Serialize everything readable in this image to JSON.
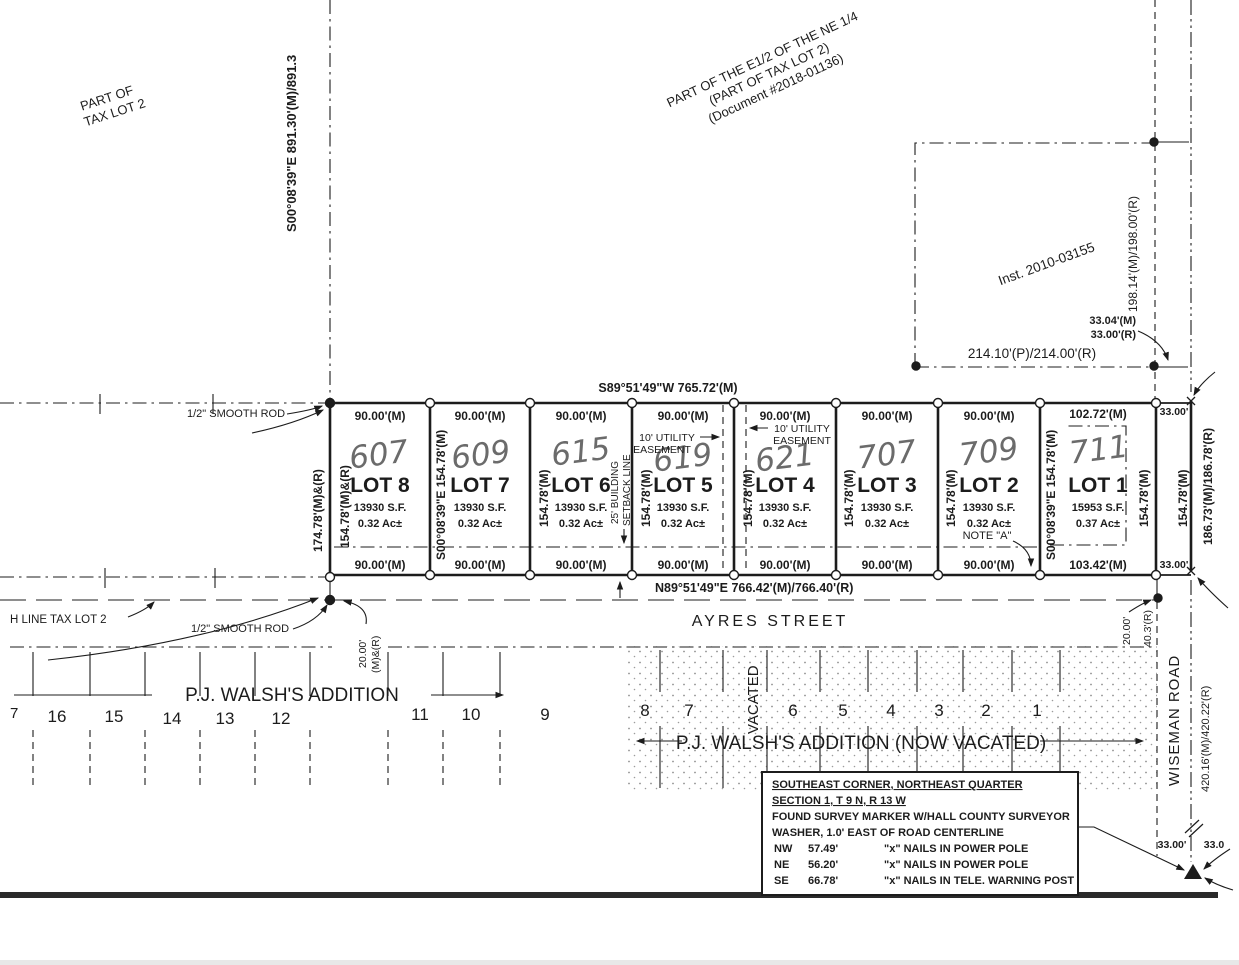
{
  "notes": {
    "tax_lot_1": "PART OF",
    "tax_lot_2": "TAX LOT 2",
    "ne_1": "PART OF THE E1/2 OF THE NE 1/4",
    "ne_2": "(PART OF TAX LOT 2)",
    "ne_3": "(Document #2018-01136)",
    "inst": "Inst. 2010-03155",
    "rod_top": "1/2\" SMOOTH ROD",
    "rod_bottom": "1/2\" SMOOTH ROD",
    "h_line": "H LINE TAX LOT 2",
    "note_a": "NOTE \"A\"",
    "utility_left_1": "10' UTILITY",
    "utility_left_2": "EASEMENT",
    "utility_right_1": "10' UTILITY",
    "utility_right_2": "EASEMENT",
    "setback_1": "25' BUILDING",
    "setback_2": "SETBACK LINE"
  },
  "dims": {
    "west_line": "S00°08'39\"E  891.30'(M)/891.3",
    "north_line": "S89°51'49\"W 765.72'(M)",
    "south_line": "N89°51'49\"E 766.42'(M)/766.40'(R)",
    "east_line": "186.73'(M)/186.78'(R)",
    "east_half": "198.14'(M)/198.00'(R)",
    "inst_south": "214.10'(P)/214.00'(R)",
    "offset_33_04": "33.04'(M)",
    "offset_33_00r": "33.00'(R)",
    "offset_33_top": "33.00'",
    "offset_33_bottom": "33.00'",
    "offset_33_br1": "33.00'",
    "offset_33_br2": "33.0",
    "lot8_west_full": "174.78'(M)&(R)",
    "lot8_west": "154.78'(M)&(R)",
    "bearing_side_a": "S00°08'39\"E 154.78'(M)",
    "bearing_side_b": "S00°08'39\"E 154.78'(M)",
    "side": "154.78'(M)",
    "road_east": "420.16'(M)/420.22'(R)",
    "offset_20": "20.00'",
    "offset_20_unit": "(M)&(R)",
    "offset_20b": "20.00'",
    "offset_40": "40.3'(R)"
  },
  "streets": {
    "ayres": "AYRES STREET",
    "wiseman": "WISEMAN ROAD"
  },
  "lots": [
    {
      "name": "LOT 8",
      "address": "607",
      "width_top": "90.00'(M)",
      "width_bottom": "90.00'(M)",
      "area_sf": "13930 S.F.",
      "area_ac": "0.32 Ac±"
    },
    {
      "name": "LOT 7",
      "address": "609",
      "width_top": "90.00'(M)",
      "width_bottom": "90.00'(M)",
      "area_sf": "13930 S.F.",
      "area_ac": "0.32 Ac±"
    },
    {
      "name": "LOT 6",
      "address": "615",
      "width_top": "90.00'(M)",
      "width_bottom": "90.00'(M)",
      "area_sf": "13930 S.F.",
      "area_ac": "0.32 Ac±"
    },
    {
      "name": "LOT 5",
      "address": "619",
      "width_top": "90.00'(M)",
      "width_bottom": "90.00'(M)",
      "area_sf": "13930 S.F.",
      "area_ac": "0.32 Ac±"
    },
    {
      "name": "LOT 4",
      "address": "621",
      "width_top": "90.00'(M)",
      "width_bottom": "90.00'(M)",
      "area_sf": "13930 S.F.",
      "area_ac": "0.32 Ac±"
    },
    {
      "name": "LOT 3",
      "address": "707",
      "width_top": "90.00'(M)",
      "width_bottom": "90.00'(M)",
      "area_sf": "13930 S.F.",
      "area_ac": "0.32 Ac±"
    },
    {
      "name": "LOT 2",
      "address": "709",
      "width_top": "90.00'(M)",
      "width_bottom": "90.00'(M)",
      "area_sf": "13930 S.F.",
      "area_ac": "0.32 Ac±"
    },
    {
      "name": "LOT 1",
      "address": "711",
      "width_top": "102.72'(M)",
      "width_bottom": "103.42'(M)",
      "area_sf": "15953 S.F.",
      "area_ac": "0.37 Ac±"
    }
  ],
  "walsh": {
    "title": "P.J.  WALSH'S   ADDITION",
    "vacated_title": "P.J. WALSH'S ADDITION (NOW VACATED)",
    "vacated": "VACATED",
    "numbers_left": [
      "7",
      "16",
      "15",
      "14",
      "13",
      "12"
    ],
    "numbers_mid": [
      "11",
      "10",
      "9"
    ],
    "numbers_vac": [
      "8",
      "7",
      "6",
      "5",
      "4",
      "3",
      "2",
      "1"
    ]
  },
  "corner_note": {
    "title1": "SOUTHEAST CORNER, NORTHEAST QUARTER",
    "title2": "SECTION 1, T 9 N, R 13 W",
    "body1": "FOUND SURVEY MARKER W/HALL COUNTY SURVEYOR",
    "body2": "WASHER, 1.0' EAST OF ROAD CENTERLINE",
    "rows": [
      {
        "dir": "NW",
        "dist": "57.49'",
        "desc": "\"x\" NAILS IN POWER POLE"
      },
      {
        "dir": "NE",
        "dist": "56.20'",
        "desc": "\"x\" NAILS IN POWER POLE"
      },
      {
        "dir": "SE",
        "dist": "66.78'",
        "desc": "\"x\" NAILS IN TELE. WARNING POST"
      }
    ]
  }
}
